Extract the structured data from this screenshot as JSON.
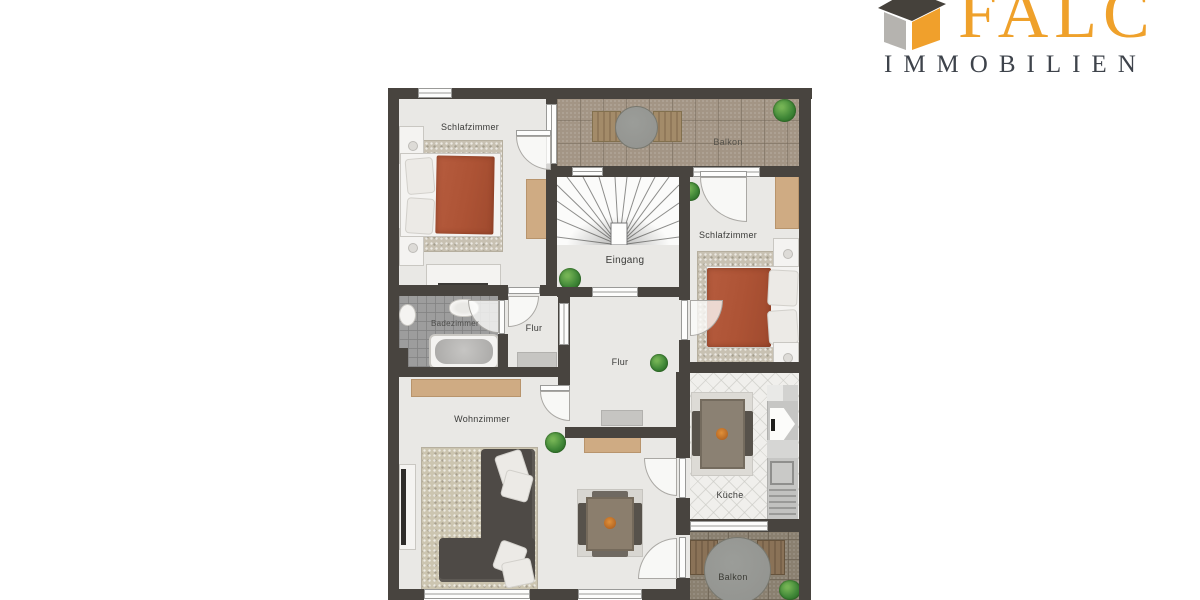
{
  "logo": {
    "brand": "FALC",
    "subtitle": "IMMOBILIEN",
    "brand_color": "#EFA12B",
    "subtitle_color": "#3E434B"
  },
  "floorplan": {
    "rooms": {
      "bedroom_top": "Schlafzimmer",
      "balcony_top": "Balkon",
      "bedroom_right": "Schlafzimmer",
      "entrance": "Eingang",
      "bathroom": "Badezimmer",
      "hall_small": "Flur",
      "hall_main": "Flur",
      "living_room": "Wohnzimmer",
      "kitchen": "Küche",
      "balcony_bottom": "Balkon"
    },
    "colors": {
      "wall": "#48443F",
      "floor": "#E9E8E5",
      "balcony_floor": "#A39585",
      "bath_floor": "#9D9D9D",
      "bed_blanket": "#AD5335",
      "sofa": "#4E4A46",
      "wood_furniture": "#CFAB83",
      "plant": "#3F8637"
    }
  }
}
